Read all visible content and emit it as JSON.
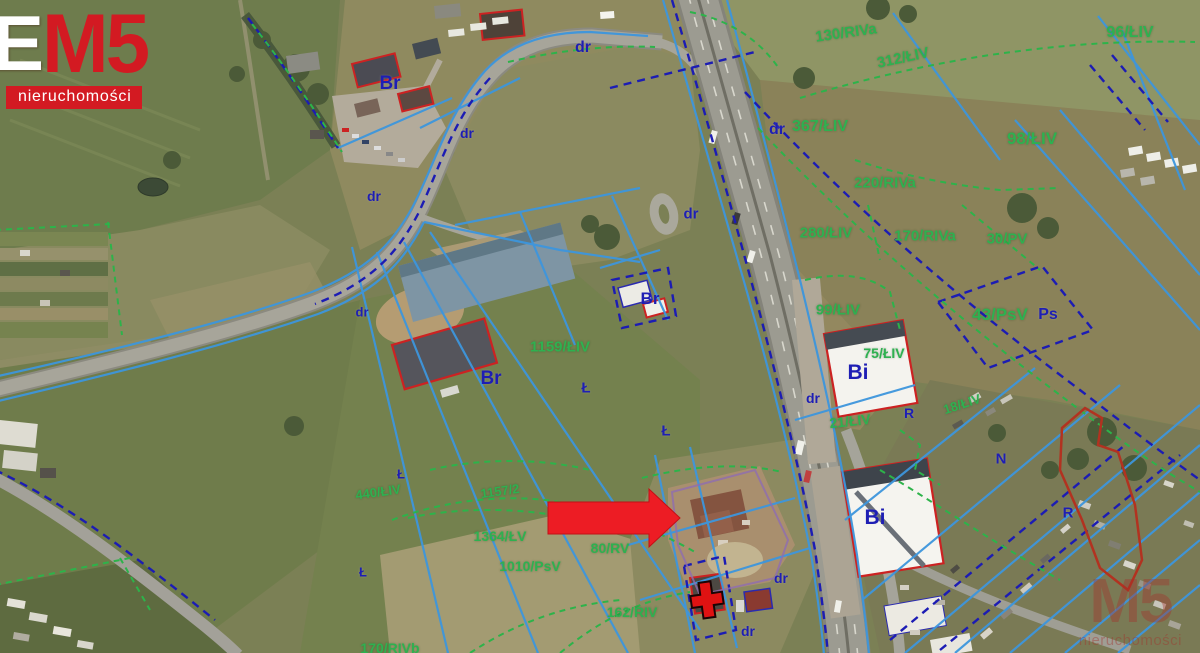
{
  "logo": {
    "e": "E",
    "m5": "M5",
    "subtitle": "nieruchomości",
    "brand_red": "#d31a22"
  },
  "watermark": {
    "m5": "M5",
    "subtitle": "nieruchomości"
  },
  "map": {
    "colors": {
      "parcel_label_green": "#2eb150",
      "landuse_label_navy": "#1e1eb4",
      "cadastral_blue": "#3d96dd",
      "cadastral_green_dashed": "#2db34a",
      "cadastral_navy_dashed": "#1c1cb4",
      "highlight_red": "#cc2222",
      "arrow_red": "#ed1c24"
    },
    "parcel_labels": [
      {
        "text": "130/RIVa",
        "x": 846,
        "y": 33,
        "size": 15,
        "rot": -8
      },
      {
        "text": "312/ŁIV",
        "x": 903,
        "y": 58,
        "size": 15,
        "rot": -12
      },
      {
        "text": "96/ŁIV",
        "x": 1130,
        "y": 33,
        "size": 16,
        "rot": 0
      },
      {
        "text": "367/ŁIV",
        "x": 820,
        "y": 127,
        "size": 16,
        "rot": 0
      },
      {
        "text": "98/ŁIV",
        "x": 1032,
        "y": 139,
        "size": 17,
        "rot": 0
      },
      {
        "text": "220/RIVa",
        "x": 885,
        "y": 183,
        "size": 15,
        "rot": 0
      },
      {
        "text": "280/ŁIV",
        "x": 826,
        "y": 233,
        "size": 15,
        "rot": 0
      },
      {
        "text": "170/RIVa",
        "x": 925,
        "y": 236,
        "size": 15,
        "rot": 0
      },
      {
        "text": "30/PV",
        "x": 1007,
        "y": 239,
        "size": 15,
        "rot": 0
      },
      {
        "text": "99/ŁIV",
        "x": 838,
        "y": 310,
        "size": 15,
        "rot": 0
      },
      {
        "text": "43/PsV",
        "x": 1000,
        "y": 315,
        "size": 17,
        "rot": 0
      },
      {
        "text": "75/ŁIV",
        "x": 884,
        "y": 353,
        "size": 14,
        "rot": 0
      },
      {
        "text": "21/ŁIV",
        "x": 850,
        "y": 421,
        "size": 14,
        "rot": -6
      },
      {
        "text": "18/ŁIV",
        "x": 962,
        "y": 404,
        "size": 13,
        "rot": -18
      },
      {
        "text": "1159/ŁIV",
        "x": 560,
        "y": 347,
        "size": 15,
        "rot": 0
      },
      {
        "text": "440/ŁIV",
        "x": 378,
        "y": 492,
        "size": 13,
        "rot": -8
      },
      {
        "text": "1157/2",
        "x": 500,
        "y": 491,
        "size": 13,
        "rot": -8
      },
      {
        "text": "1364/ŁV",
        "x": 500,
        "y": 536,
        "size": 14,
        "rot": 0
      },
      {
        "text": "80/RV",
        "x": 610,
        "y": 548,
        "size": 14,
        "rot": 0
      },
      {
        "text": "1010/PsV",
        "x": 530,
        "y": 566,
        "size": 14,
        "rot": 0
      },
      {
        "text": "162/RIV",
        "x": 632,
        "y": 612,
        "size": 14,
        "rot": 0
      },
      {
        "text": "170/RIVb",
        "x": 390,
        "y": 648,
        "size": 14,
        "rot": 0
      }
    ],
    "landuse_labels": [
      {
        "text": "Br",
        "x": 390,
        "y": 84,
        "size": 19,
        "rot": 0
      },
      {
        "text": "dr",
        "x": 583,
        "y": 48,
        "size": 16,
        "rot": 0
      },
      {
        "text": "dr",
        "x": 467,
        "y": 133,
        "size": 14,
        "rot": 0
      },
      {
        "text": "dr",
        "x": 374,
        "y": 196,
        "size": 14,
        "rot": 0
      },
      {
        "text": "dr",
        "x": 362,
        "y": 312,
        "size": 13,
        "rot": 0
      },
      {
        "text": "dr",
        "x": 691,
        "y": 214,
        "size": 15,
        "rot": 0
      },
      {
        "text": "dr",
        "x": 777,
        "y": 130,
        "size": 16,
        "rot": 0
      },
      {
        "text": "Br",
        "x": 650,
        "y": 299,
        "size": 17,
        "rot": 0
      },
      {
        "text": "Br",
        "x": 491,
        "y": 379,
        "size": 19,
        "rot": 0
      },
      {
        "text": "Ł",
        "x": 586,
        "y": 388,
        "size": 15,
        "rot": 0
      },
      {
        "text": "Ł",
        "x": 666,
        "y": 431,
        "size": 15,
        "rot": 0
      },
      {
        "text": "Ł",
        "x": 401,
        "y": 474,
        "size": 13,
        "rot": 0
      },
      {
        "text": "Ł",
        "x": 363,
        "y": 572,
        "size": 13,
        "rot": 0
      },
      {
        "text": "dr",
        "x": 813,
        "y": 398,
        "size": 14,
        "rot": 0
      },
      {
        "text": "R",
        "x": 909,
        "y": 413,
        "size": 14,
        "rot": 0
      },
      {
        "text": "Ps",
        "x": 1048,
        "y": 315,
        "size": 16,
        "rot": 0
      },
      {
        "text": "Bi",
        "x": 858,
        "y": 373,
        "size": 21,
        "rot": 0
      },
      {
        "text": "Bi",
        "x": 875,
        "y": 518,
        "size": 21,
        "rot": 0
      },
      {
        "text": "N",
        "x": 1001,
        "y": 459,
        "size": 15,
        "rot": 0
      },
      {
        "text": "R",
        "x": 1068,
        "y": 513,
        "size": 15,
        "rot": 0
      },
      {
        "text": "dr",
        "x": 781,
        "y": 578,
        "size": 14,
        "rot": 0
      },
      {
        "text": "dr",
        "x": 748,
        "y": 631,
        "size": 14,
        "rot": 0
      }
    ]
  }
}
